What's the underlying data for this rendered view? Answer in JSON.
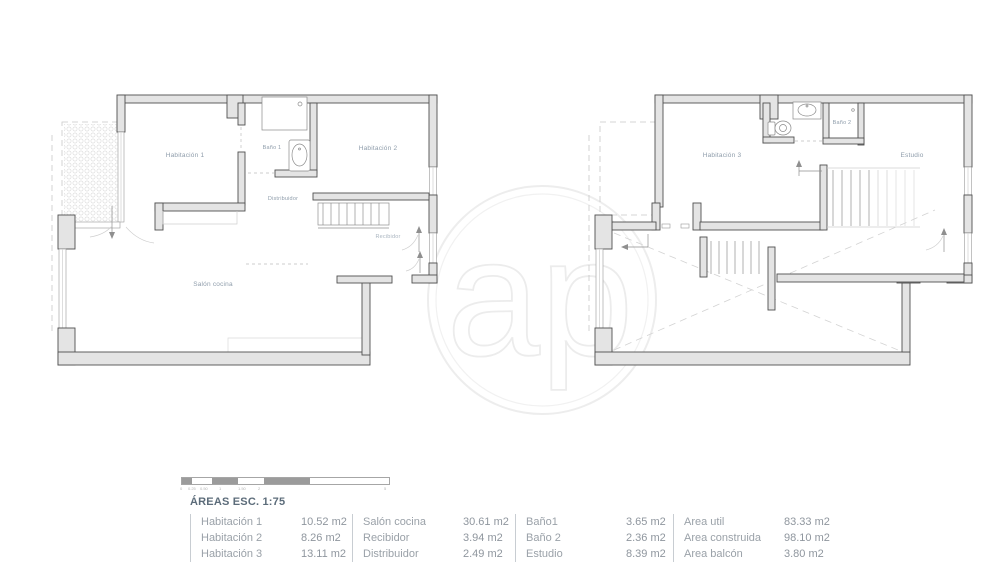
{
  "header": {
    "areas_title": "ÁREAS ESC. 1:75"
  },
  "watermark": {
    "text": "ap"
  },
  "plans": {
    "left": {
      "rooms": {
        "habitacion1": "Habitación 1",
        "bano1": "Baño 1",
        "habitacion2": "Habitación 2",
        "distribuidor": "Distribuidor",
        "recibidor": "Recibidor",
        "salon_cocina": "Salón cocina"
      }
    },
    "right": {
      "rooms": {
        "habitacion3": "Habitación 3",
        "bano2": "Baño 2",
        "estudio": "Estudio"
      }
    }
  },
  "scale": {
    "ticks": [
      "0",
      "0.25",
      "0.50",
      "1",
      "1.50",
      "2",
      "5"
    ]
  },
  "table": {
    "groups": [
      {
        "rows": [
          {
            "label": "Habitación 1",
            "value": "10.52 m2"
          },
          {
            "label": "Habitación 2",
            "value": "8.26 m2"
          },
          {
            "label": "Habitación 3",
            "value": "13.11 m2"
          }
        ]
      },
      {
        "rows": [
          {
            "label": "Salón cocina",
            "value": "30.61 m2"
          },
          {
            "label": "Recibidor",
            "value": "3.94 m2"
          },
          {
            "label": "Distribuidor",
            "value": "2.49 m2"
          }
        ]
      },
      {
        "rows": [
          {
            "label": "Baño1",
            "value": "3.65 m2"
          },
          {
            "label": "Baño 2",
            "value": "2.36 m2"
          },
          {
            "label": "Estudio",
            "value": "8.39 m2"
          }
        ]
      },
      {
        "rows": [
          {
            "label": "Area util",
            "value": "83.33 m2"
          },
          {
            "label": "Area construida",
            "value": "98.10 m2"
          },
          {
            "label": "Area balcón",
            "value": "3.80 m2"
          }
        ]
      }
    ]
  },
  "colors": {
    "wall_fill": "#e4e4e4",
    "wall_stroke": "#4f4f4f",
    "label_text": "#8f9dab",
    "table_text": "#9aa1a8",
    "title_text": "#5c6c7a",
    "watermark": "#ededed"
  }
}
